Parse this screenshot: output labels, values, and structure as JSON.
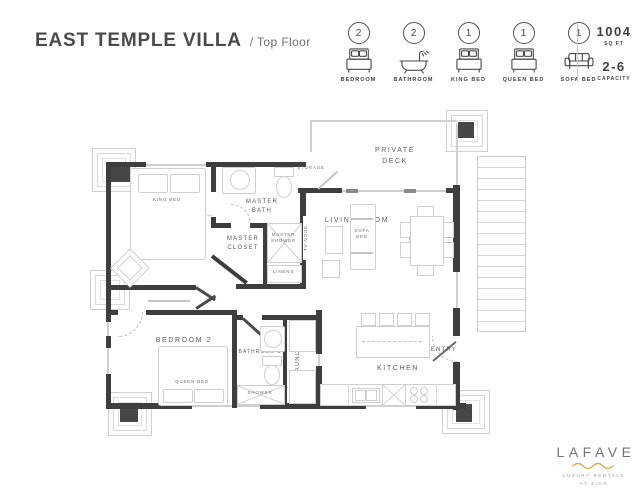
{
  "header": {
    "title": "EAST TEMPLE VILLA",
    "subtitle": "/ Top Floor",
    "features": [
      {
        "count": "2",
        "label": "BEDROOM",
        "icon": "bed-icon"
      },
      {
        "count": "2",
        "label": "BATHROOM",
        "icon": "bathtub-icon"
      },
      {
        "count": "1",
        "label": "KING BED",
        "icon": "bed-icon"
      },
      {
        "count": "1",
        "label": "QUEEN BED",
        "icon": "bed-icon"
      },
      {
        "count": "1",
        "label": "SOFA BED",
        "icon": "sofa-icon"
      }
    ],
    "stats": [
      {
        "value": "1004",
        "label": "SQ FT"
      },
      {
        "value": "2-6",
        "label": "CAPACITY"
      }
    ]
  },
  "floorplan": {
    "rooms": {
      "master_bedroom": "MASTER BEDROOM",
      "king_bed": "KING BED",
      "master_bath": "MASTER BATH",
      "master_closet": "MASTER CLOSET",
      "master_shower": "MASTER SHOWER",
      "linens": "LINENS",
      "storage": "STORAGE",
      "tv_nook": "TV NOOK",
      "private_deck": "PRIVATE DECK",
      "living_room": "LIVING ROOM",
      "sofa_bed": "SOFA BED",
      "dining": "DINING",
      "kitchen": "KITCHEN",
      "entry": "ENTRY",
      "bedroom_2": "BEDROOM 2",
      "queen_bed": "QUEEN BED",
      "bathroom_2": "BATHROOM 2",
      "shower": "SHOWER",
      "laundry": "LAUNDRY"
    }
  },
  "footer": {
    "brand": "LAFAVE",
    "tagline_line1": "LUXURY RENTALS",
    "tagline_line2": "AT ZION"
  },
  "colors": {
    "wall": "#3e3e3e",
    "light_line": "#cfcfcf",
    "text": "#4a4a4a",
    "gold": "#d4af5e"
  }
}
